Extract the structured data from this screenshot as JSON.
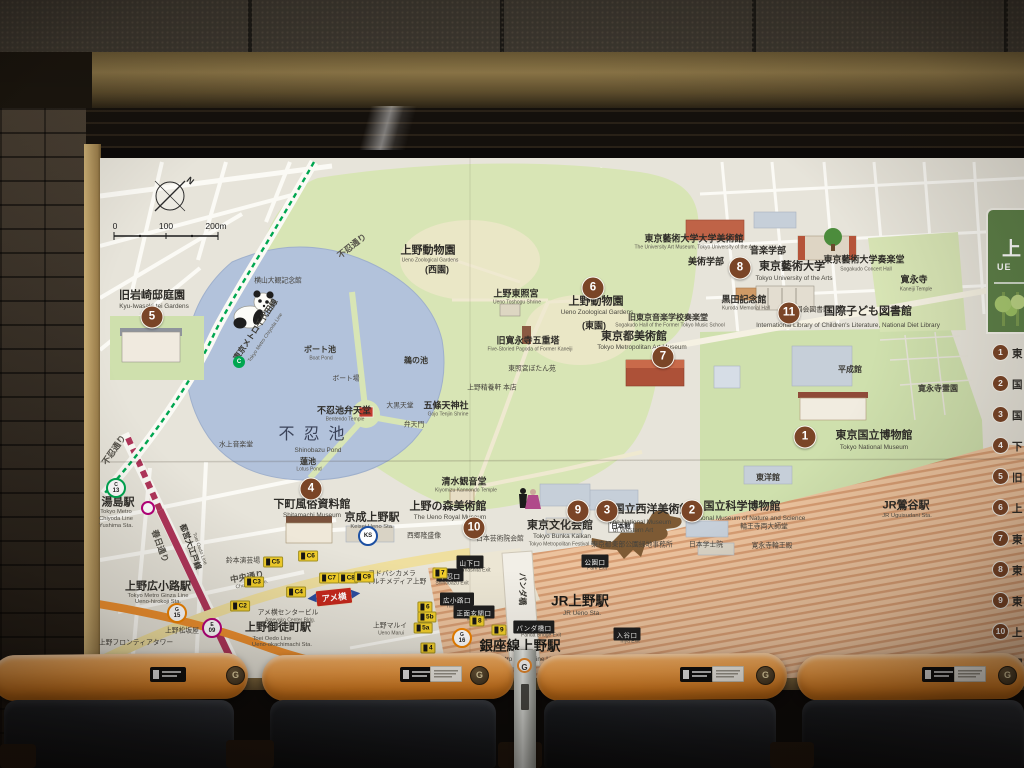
{
  "scene": {
    "panel": {
      "title_jp": "上",
      "title_en": "UE",
      "items": [
        {
          "n": "1",
          "t": "東"
        },
        {
          "n": "2",
          "t": "国"
        },
        {
          "n": "3",
          "t": "国"
        },
        {
          "n": "4",
          "t": "下"
        },
        {
          "n": "5",
          "t": "旧"
        },
        {
          "n": "6",
          "t": "上"
        },
        {
          "n": "7",
          "t": "東"
        },
        {
          "n": "8",
          "t": "東"
        },
        {
          "n": "9",
          "t": "東"
        },
        {
          "n": "10",
          "t": "上"
        },
        {
          "n": "11",
          "t": "国"
        }
      ]
    },
    "compass_n": "N",
    "scale": {
      "n0": "0",
      "n100": "100",
      "n200": "200m"
    },
    "ameyoko": "アメ横",
    "seat_g": "G",
    "pole_g": "G"
  },
  "colors": {
    "marker": "#7a4527",
    "park": "#d8e5b5",
    "pond": "#b2c2db",
    "ginza": "#ee8f2e",
    "oedo": "#b0355a",
    "chiyoda": "#00a650",
    "panel_green": "#5d8048",
    "seat_orange": "#ef9c44"
  },
  "map": {
    "markers": [
      {
        "n": "1",
        "x": 805,
        "y": 437
      },
      {
        "n": "2",
        "x": 692,
        "y": 511
      },
      {
        "n": "3",
        "x": 607,
        "y": 511
      },
      {
        "n": "4",
        "x": 311,
        "y": 489
      },
      {
        "n": "5",
        "x": 152,
        "y": 317
      },
      {
        "n": "6",
        "x": 593,
        "y": 288
      },
      {
        "n": "7",
        "x": 663,
        "y": 357
      },
      {
        "n": "8",
        "x": 740,
        "y": 268
      },
      {
        "n": "9",
        "x": 578,
        "y": 511
      },
      {
        "n": "10",
        "x": 474,
        "y": 528
      },
      {
        "n": "11",
        "x": 789,
        "y": 313
      }
    ],
    "labels": [
      {
        "t": "上野動物園",
        "x": 428,
        "y": 251,
        "c": "jp-lg"
      },
      {
        "t": "Ueno Zoological Gardens",
        "x": 430,
        "y": 261,
        "c": "en-xxs"
      },
      {
        "t": "(西園)",
        "x": 437,
        "y": 270,
        "c": "jp-md"
      },
      {
        "t": "上野東照宮",
        "x": 516,
        "y": 294,
        "c": "jp-md"
      },
      {
        "t": "Ueno Toshogu Shrine",
        "x": 517,
        "y": 303,
        "c": "en-xxs"
      },
      {
        "t": "旧寛永寺五重塔",
        "x": 528,
        "y": 341,
        "c": "jp-md"
      },
      {
        "t": "Five-Storied Pagoda of Former Kaneiji",
        "x": 530,
        "y": 350,
        "c": "en-xxs"
      },
      {
        "t": "(東園)",
        "x": 594,
        "y": 326,
        "c": "jp-md"
      },
      {
        "t": "上野動物園",
        "x": 596,
        "y": 302,
        "c": "jp-lg"
      },
      {
        "t": "Ueno Zoological Gardens",
        "x": 597,
        "y": 313,
        "c": "en-sm"
      },
      {
        "t": "東照宮ぼたん苑",
        "x": 532,
        "y": 370,
        "c": "jp-xs"
      },
      {
        "t": "上野精養軒 本店",
        "x": 492,
        "y": 389,
        "c": "jp-xs"
      },
      {
        "t": "五條天神社",
        "x": 446,
        "y": 406,
        "c": "jp-md"
      },
      {
        "t": "Gojo Tenjin Shrine",
        "x": 448,
        "y": 415,
        "c": "en-xxs"
      },
      {
        "t": "清水観音堂",
        "x": 464,
        "y": 482,
        "c": "jp-md"
      },
      {
        "t": "Kiyomizu Kannondo Temple",
        "x": 466,
        "y": 491,
        "c": "en-xxs"
      },
      {
        "t": "西郷隆盛像",
        "x": 424,
        "y": 537,
        "c": "jp-xs"
      },
      {
        "t": "東京都美術館",
        "x": 634,
        "y": 337,
        "c": "jp-lg"
      },
      {
        "t": "Tokyo Metropolitan Art Museum",
        "x": 642,
        "y": 348,
        "c": "en-sm"
      },
      {
        "t": "旧東京音楽学校奏楽堂",
        "x": 668,
        "y": 318,
        "c": "jp-sm"
      },
      {
        "t": "Sogakudo Hall of the Former Tokyo Music School",
        "x": 670,
        "y": 326,
        "c": "en-xxs"
      },
      {
        "t": "東京藝術大学大学美術館",
        "x": 694,
        "y": 239,
        "c": "jp-md"
      },
      {
        "t": "The University Art Museum, Tokyo University of the Arts",
        "x": 696,
        "y": 248,
        "c": "en-xxs"
      },
      {
        "t": "美術学部",
        "x": 706,
        "y": 262,
        "c": "jp-md"
      },
      {
        "t": "音楽学部",
        "x": 768,
        "y": 251,
        "c": "jp-md"
      },
      {
        "t": "東京藝術大学",
        "x": 792,
        "y": 267,
        "c": "jp-lg"
      },
      {
        "t": "Tokyo University of the Arts",
        "x": 794,
        "y": 279,
        "c": "en-sm"
      },
      {
        "t": "東京藝術大学奏楽堂",
        "x": 864,
        "y": 260,
        "c": "jp-md"
      },
      {
        "t": "Sogakudo Concert Hall",
        "x": 866,
        "y": 270,
        "c": "en-xxs"
      },
      {
        "t": "黒田記念館",
        "x": 744,
        "y": 300,
        "c": "jp-md"
      },
      {
        "t": "Kuroda Memorial Hall",
        "x": 746,
        "y": 309,
        "c": "en-xxs"
      },
      {
        "t": "寛永寺",
        "x": 914,
        "y": 280,
        "c": "jp-md"
      },
      {
        "t": "Kaneiji Temple",
        "x": 916,
        "y": 290,
        "c": "en-xxs"
      },
      {
        "t": "国立国会図書館",
        "x": 806,
        "y": 311,
        "c": "jp-xs"
      },
      {
        "t": "国際子ども図書館",
        "x": 868,
        "y": 312,
        "c": "jp-lg"
      },
      {
        "t": "International Library of Children's Literature, National Diet Library",
        "x": 848,
        "y": 326,
        "c": "en-sm"
      },
      {
        "t": "平成館",
        "x": 850,
        "y": 370,
        "c": "jp-sm"
      },
      {
        "t": "東洋館",
        "x": 768,
        "y": 478,
        "c": "jp-sm"
      },
      {
        "t": "寛永寺霊園",
        "x": 938,
        "y": 389,
        "c": "jp-sm"
      },
      {
        "t": "東京国立博物館",
        "x": 874,
        "y": 436,
        "c": "jp-lg"
      },
      {
        "t": "Tokyo National Museum",
        "x": 874,
        "y": 448,
        "c": "en-sm"
      },
      {
        "t": "JR鶯谷駅",
        "x": 906,
        "y": 506,
        "c": "jp-lg"
      },
      {
        "t": "JR Uguisudani Sta.",
        "x": 907,
        "y": 517,
        "c": "en-xs"
      },
      {
        "t": "国立科学博物館",
        "x": 742,
        "y": 507,
        "c": "jp-lg"
      },
      {
        "t": "National Museum of Nature and Science",
        "x": 748,
        "y": 519,
        "c": "en-sm"
      },
      {
        "t": "日本館",
        "x": 621,
        "y": 527,
        "c": "tag-white"
      },
      {
        "t": "日本学士院",
        "x": 706,
        "y": 546,
        "c": "jp-xs"
      },
      {
        "t": "寛永寺輪王殿",
        "x": 772,
        "y": 547,
        "c": "jp-xs"
      },
      {
        "t": "輪王寺両大師堂",
        "x": 764,
        "y": 528,
        "c": "jp-xs"
      },
      {
        "t": "国立西洋美術館",
        "x": 652,
        "y": 510,
        "c": "jp-lg"
      },
      {
        "t": "The National Museum",
        "x": 640,
        "y": 523,
        "c": "en-sm"
      },
      {
        "t": "of Western Art",
        "x": 633,
        "y": 531,
        "c": "en-sm"
      },
      {
        "t": "東京都東部公園緑地事務所",
        "x": 632,
        "y": 546,
        "c": "jp-xs"
      },
      {
        "t": "東京文化会館",
        "x": 560,
        "y": 526,
        "c": "jp-lg"
      },
      {
        "t": "Tokyo Bunka Kaikan",
        "x": 562,
        "y": 537,
        "c": "en-sm"
      },
      {
        "t": "Tokyo Metropolitan Festival Hall",
        "x": 564,
        "y": 545,
        "c": "en-xxs"
      },
      {
        "t": "上野の森美術館",
        "x": 448,
        "y": 507,
        "c": "jp-lg"
      },
      {
        "t": "The Ueno Royal Museum",
        "x": 450,
        "y": 518,
        "c": "en-sm"
      },
      {
        "t": "日本芸術院会館",
        "x": 500,
        "y": 540,
        "c": "jp-xs"
      },
      {
        "t": "不忍池弁天堂",
        "x": 344,
        "y": 411,
        "c": "jp-md"
      },
      {
        "t": "Bentendo Temple",
        "x": 345,
        "y": 420,
        "c": "en-xxs"
      },
      {
        "t": "大黒天堂",
        "x": 400,
        "y": 407,
        "c": "jp-xs"
      },
      {
        "t": "弁天門",
        "x": 414,
        "y": 426,
        "c": "jp-xs"
      },
      {
        "t": "ボート池",
        "x": 320,
        "y": 350,
        "c": "jp-sm"
      },
      {
        "t": "Boat Pond",
        "x": 321,
        "y": 359,
        "c": "en-xxs"
      },
      {
        "t": "鵜の池",
        "x": 416,
        "y": 361,
        "c": "jp-sm"
      },
      {
        "t": "ボート場",
        "x": 346,
        "y": 380,
        "c": "jp-xs"
      },
      {
        "t": "不忍池",
        "x": 316,
        "y": 435,
        "c": "pond-xl"
      },
      {
        "t": "Shinobazu Pond",
        "x": 318,
        "y": 451,
        "c": "en-sm"
      },
      {
        "t": "蓮池",
        "x": 308,
        "y": 462,
        "c": "jp-sm"
      },
      {
        "t": "Lotus Pond",
        "x": 309,
        "y": 470,
        "c": "en-xxs"
      },
      {
        "t": "水上音楽堂",
        "x": 236,
        "y": 446,
        "c": "jp-xs"
      },
      {
        "t": "横山大観記念館",
        "x": 278,
        "y": 282,
        "c": "jp-xs"
      },
      {
        "t": "旧岩崎邸庭園",
        "x": 152,
        "y": 296,
        "c": "jp-lg"
      },
      {
        "t": "Kyu-Iwasaki-tei Gardens",
        "x": 154,
        "y": 307,
        "c": "en-sm"
      },
      {
        "t": "湯島駅",
        "x": 118,
        "y": 503,
        "c": "jp-lg"
      },
      {
        "t": "Tokyo Metro",
        "x": 116,
        "y": 513,
        "c": "en-xs"
      },
      {
        "t": "Chiyoda Line",
        "x": 116,
        "y": 520,
        "c": "en-xs"
      },
      {
        "t": "Yushima Sta.",
        "x": 116,
        "y": 527,
        "c": "en-xs"
      },
      {
        "t": "上野広小路駅",
        "x": 158,
        "y": 587,
        "c": "jp-lg"
      },
      {
        "t": "Tokyo Metro Ginza Line",
        "x": 158,
        "y": 597,
        "c": "en-xs"
      },
      {
        "t": "Ueno-hirokoji Sta.",
        "x": 158,
        "y": 603,
        "c": "en-xs"
      },
      {
        "t": "上野御徒町駅",
        "x": 278,
        "y": 628,
        "c": "jp-lg"
      },
      {
        "t": "Toei Oedo Line",
        "x": 272,
        "y": 640,
        "c": "en-xs"
      },
      {
        "t": "Ueno-okachimachi Sta.",
        "x": 282,
        "y": 646,
        "c": "en-xs"
      },
      {
        "t": "京成上野駅",
        "x": 372,
        "y": 518,
        "c": "jp-lg"
      },
      {
        "t": "Keisei Ueno Sta.",
        "x": 372,
        "y": 528,
        "c": "en-xs"
      },
      {
        "t": "下町風俗資料館",
        "x": 312,
        "y": 505,
        "c": "jp-lg"
      },
      {
        "t": "Shitamachi Museum",
        "x": 312,
        "y": 516,
        "c": "en-sm"
      },
      {
        "t": "JR上野駅",
        "x": 580,
        "y": 601,
        "c": "jp-xl"
      },
      {
        "t": "JR Ueno Sta.",
        "x": 582,
        "y": 614,
        "c": "en-sm"
      },
      {
        "t": "銀座線上野駅",
        "x": 520,
        "y": 646,
        "c": "jp-xl"
      },
      {
        "t": "Tokyo Metro Ginza Line Ueno Sta.",
        "x": 526,
        "y": 660,
        "c": "en-sm"
      },
      {
        "t": "中央通り",
        "x": 247,
        "y": 577,
        "c": "road",
        "r": -10
      },
      {
        "t": "Chuo-dori Ave.",
        "x": 252,
        "y": 585,
        "c": "en-xxs",
        "r": -10
      },
      {
        "t": "不忍通り",
        "x": 352,
        "y": 246,
        "c": "road",
        "r": -38
      },
      {
        "t": "不忍通り",
        "x": 114,
        "y": 450,
        "c": "road",
        "r": -55
      },
      {
        "t": "東京メトロ千代田線",
        "x": 256,
        "y": 330,
        "c": "line-name",
        "r": -56
      },
      {
        "t": "Tokyo Metro Chiyoda Line",
        "x": 266,
        "y": 338,
        "c": "en-xxs",
        "r": -56
      },
      {
        "t": "都営大江戸線",
        "x": 190,
        "y": 547,
        "c": "line-name",
        "r": 70
      },
      {
        "t": "Toei Oedo Line",
        "x": 199,
        "y": 549,
        "c": "en-xxs",
        "r": 70
      },
      {
        "t": "春日通り",
        "x": 160,
        "y": 546,
        "c": "road",
        "r": 70
      },
      {
        "t": "パンダ橋",
        "x": 522,
        "y": 589,
        "c": "jp-sm",
        "r": 90
      },
      {
        "t": "鈴本演芸場",
        "x": 243,
        "y": 562,
        "c": "jp-xs"
      },
      {
        "t": "アメ横センタービル",
        "x": 288,
        "y": 614,
        "c": "jp-xs"
      },
      {
        "t": "Ameyoko Center Bldg.",
        "x": 290,
        "y": 621,
        "c": "en-xxs"
      },
      {
        "t": "ヨドバシカメラ",
        "x": 392,
        "y": 575,
        "c": "jp-xs"
      },
      {
        "t": "マルチメディア上野",
        "x": 396,
        "y": 583,
        "c": "jp-xs"
      },
      {
        "t": "上野マルイ",
        "x": 390,
        "y": 627,
        "c": "jp-xs"
      },
      {
        "t": "Ueno Marui",
        "x": 391,
        "y": 634,
        "c": "en-xxs"
      },
      {
        "t": "上野松坂屋",
        "x": 182,
        "y": 632,
        "c": "jp-xs"
      },
      {
        "t": "上野フロンティアタワー",
        "x": 136,
        "y": 644,
        "c": "jp-xs"
      },
      {
        "t": "Yamashita Exit",
        "x": 474,
        "y": 571,
        "c": "en-xxs"
      },
      {
        "t": "Shinobazu Exit",
        "x": 452,
        "y": 584,
        "c": "en-xxs"
      },
      {
        "t": "Hirokoji Exit",
        "x": 460,
        "y": 607,
        "c": "en-xxs"
      },
      {
        "t": "Main Exit",
        "x": 477,
        "y": 620,
        "c": "en-xxs"
      },
      {
        "t": "Panda Bridge Exit",
        "x": 541,
        "y": 636,
        "c": "en-xxs"
      },
      {
        "t": "Park Exit",
        "x": 597,
        "y": 569,
        "c": "en-xxs"
      },
      {
        "t": "Iriya Exit",
        "x": 630,
        "y": 642,
        "c": "en-xxs"
      }
    ],
    "black_tags": [
      {
        "t": "山下口",
        "x": 470,
        "y": 562
      },
      {
        "t": "不忍口",
        "x": 450,
        "y": 575
      },
      {
        "t": "広小路口",
        "x": 457,
        "y": 599
      },
      {
        "t": "正面玄関口",
        "x": 474,
        "y": 612
      },
      {
        "t": "パンダ橋口",
        "x": 534,
        "y": 627
      },
      {
        "t": "公園口",
        "x": 595,
        "y": 561
      },
      {
        "t": "入谷口",
        "x": 627,
        "y": 634
      }
    ],
    "exit_badges": [
      {
        "t": "7",
        "x": 440,
        "y": 573
      },
      {
        "t": "6",
        "x": 425,
        "y": 607
      },
      {
        "t": "5b",
        "x": 427,
        "y": 617
      },
      {
        "t": "5a",
        "x": 423,
        "y": 628
      },
      {
        "t": "4",
        "x": 428,
        "y": 648
      },
      {
        "t": "8",
        "x": 477,
        "y": 621
      },
      {
        "t": "9",
        "x": 499,
        "y": 630
      },
      {
        "t": "C5",
        "x": 273,
        "y": 562
      },
      {
        "t": "C6",
        "x": 308,
        "y": 556
      },
      {
        "t": "C7",
        "x": 329,
        "y": 578
      },
      {
        "t": "C8",
        "x": 348,
        "y": 578
      },
      {
        "t": "C9",
        "x": 364,
        "y": 577
      },
      {
        "t": "C2",
        "x": 240,
        "y": 606
      },
      {
        "t": "C3",
        "x": 254,
        "y": 582
      },
      {
        "t": "C4",
        "x": 296,
        "y": 592
      }
    ],
    "line_badges": [
      {
        "letter": "C",
        "num": "13",
        "color": "#00a650",
        "x": 116,
        "y": 488
      },
      {
        "letter": "G",
        "num": "15",
        "color": "#f08300",
        "x": 177,
        "y": 613
      },
      {
        "letter": "G",
        "num": "16",
        "color": "#f08300",
        "x": 462,
        "y": 638
      },
      {
        "letter": "E",
        "num": "09",
        "color": "#b6007a",
        "x": 212,
        "y": 628
      },
      {
        "letter": "KS",
        "num": "",
        "color": "#1d50a2",
        "x": 368,
        "y": 536
      },
      {
        "letter": "C",
        "num": "",
        "color": "#00a650",
        "x": 239,
        "y": 362,
        "solid": true
      },
      {
        "letter": "",
        "num": "",
        "color": "#b6007a",
        "x": 148,
        "y": 508,
        "ring": true
      }
    ]
  }
}
